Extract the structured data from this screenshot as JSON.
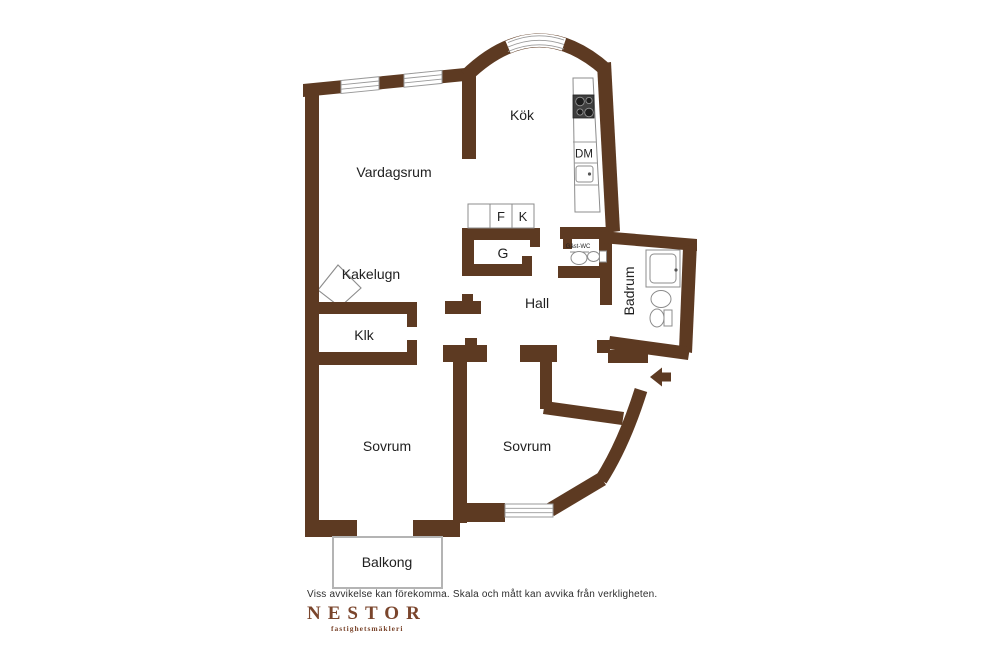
{
  "colors": {
    "wall": "#5d3a22",
    "window": "#9a9a9a",
    "fixture": "#8c8c8c",
    "stove": "#3f3f3f",
    "balcony": "#b4b4b4",
    "label": "#1f1f1f",
    "muted": "#2e2e2e",
    "logo": "#7a452c"
  },
  "floorplan": {
    "rooms": {
      "vardagsrum": {
        "label": "Vardagsrum"
      },
      "kok": {
        "label": "Kök"
      },
      "hall": {
        "label": "Hall"
      },
      "badrum": {
        "label": "Badrum"
      },
      "gast_wc": {
        "label": "Gäst-WC"
      },
      "klk": {
        "label": "Klk"
      },
      "sovrum1": {
        "label": "Sovrum"
      },
      "sovrum2": {
        "label": "Sovrum"
      },
      "balkong": {
        "label": "Balkong"
      }
    },
    "features": {
      "kakelugn": {
        "label": "Kakelugn"
      },
      "garderob": {
        "label": "G"
      },
      "fridge": {
        "label": "F"
      },
      "freezer": {
        "label": "K"
      },
      "dishwasher": {
        "label": "DM"
      }
    }
  },
  "footer": {
    "disclaimer": "Viss avvikelse kan förekomma. Skala och mått kan avvika från verkligheten.",
    "brand": "NESTOR",
    "tagline": "fastighetsmäkleri"
  }
}
